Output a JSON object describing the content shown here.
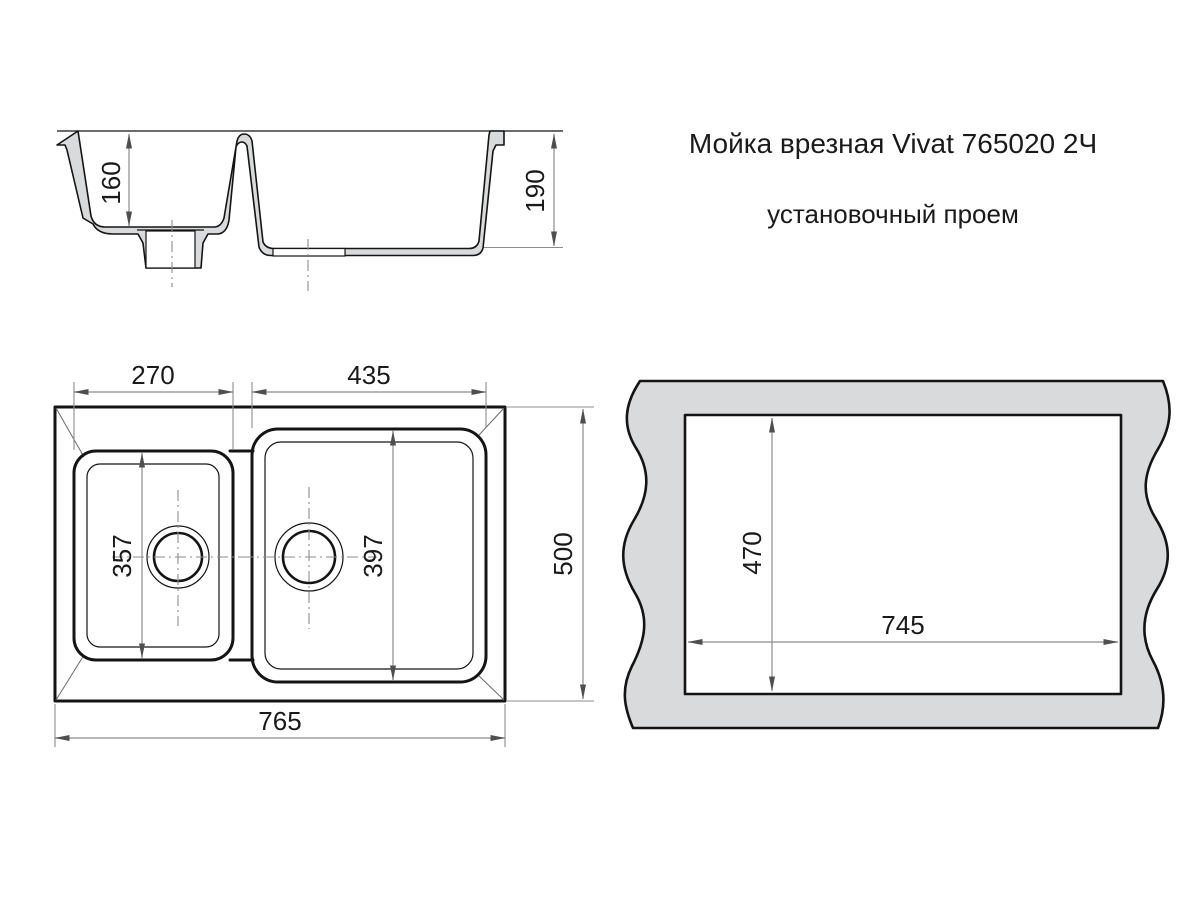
{
  "title": "Мойка врезная Vivat 765020 2Ч",
  "subtitle": "установочный проем",
  "colors": {
    "paper": "#ffffff",
    "ink": "#141414",
    "text_color": "#1a1a1a",
    "dim_line": "#8c8c8c",
    "arrow": "#4f4f4f",
    "diag": "#6a6a6a",
    "section_fill": "#d9dadb"
  },
  "views": {
    "section": {
      "name": "cross-section",
      "left_bowl_depth": "160",
      "right_bowl_depth": "190"
    },
    "top": {
      "name": "top view",
      "small_bowl_width": "270",
      "large_bowl_width": "435",
      "small_bowl_length": "357",
      "large_bowl_length": "397",
      "overall_length": "765",
      "overall_width": "500"
    },
    "cutout": {
      "name": "installation cutout",
      "height": "470",
      "width": "745"
    }
  }
}
